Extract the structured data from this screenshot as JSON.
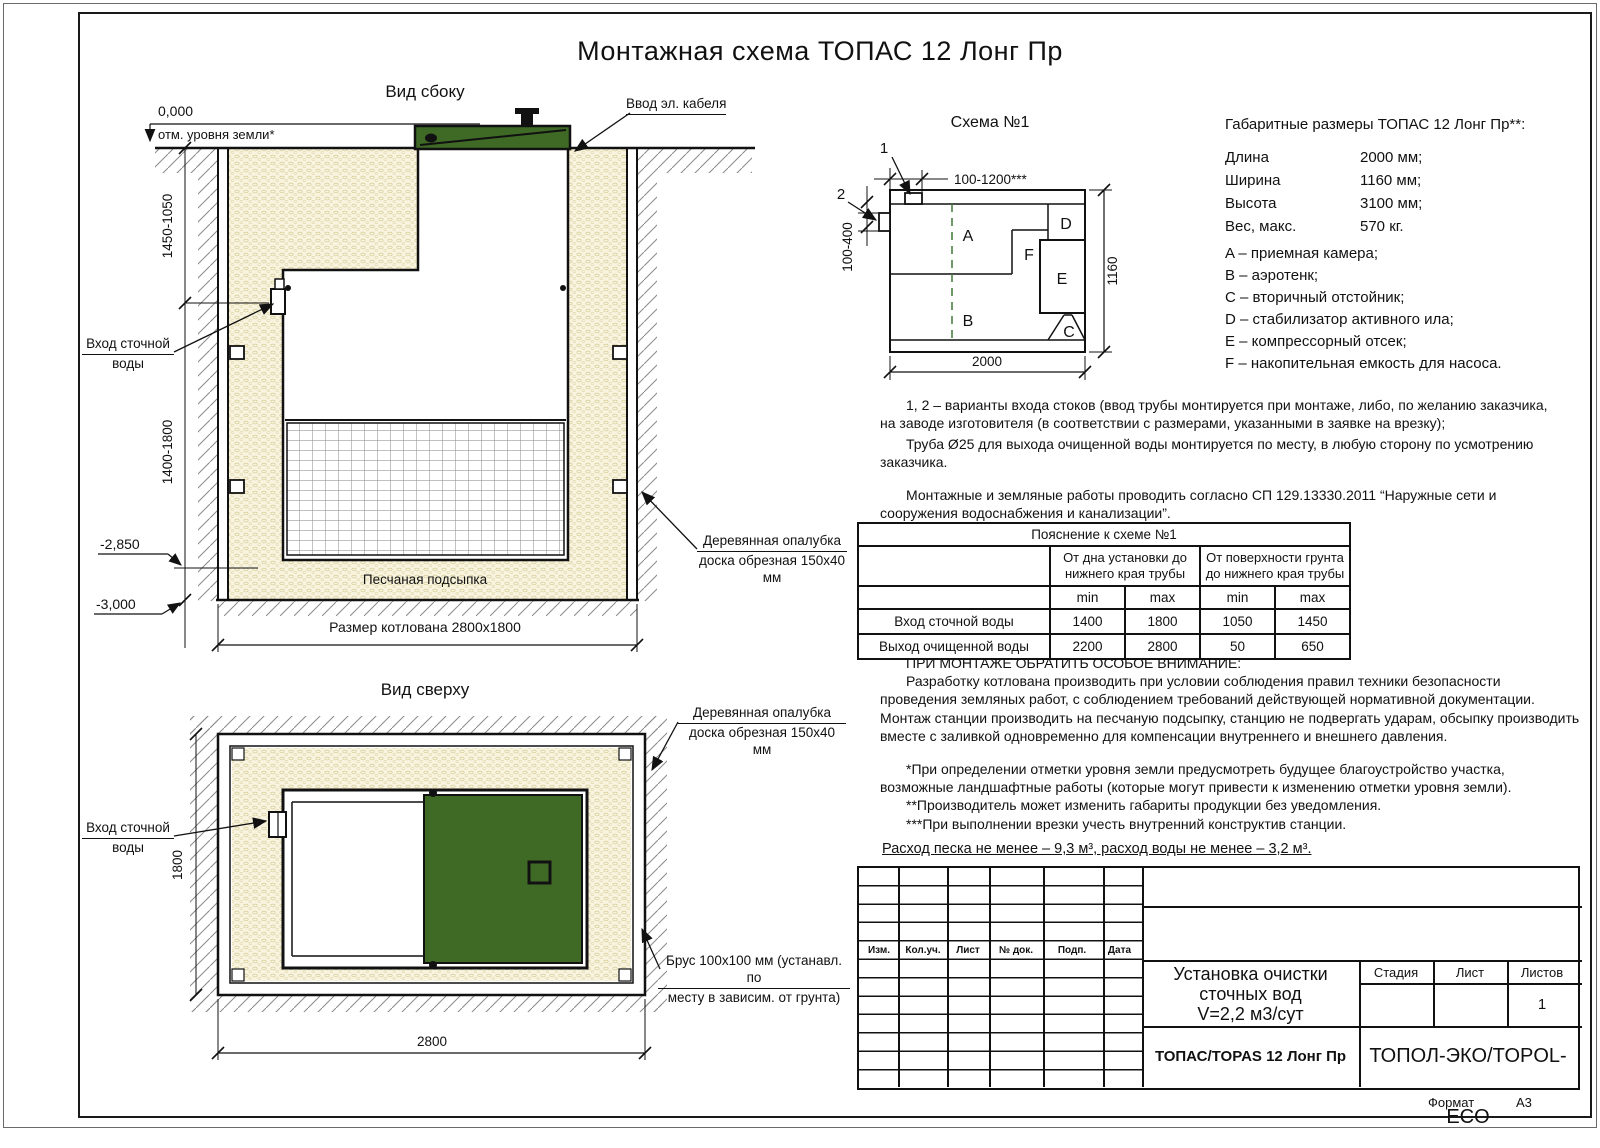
{
  "title": "Монтажная схема ТОПАС 12 Лонг Пр",
  "side_view": {
    "title": "Вид сбоку",
    "zero_mark": "0,000",
    "ground_label": "отм. уровня земли*",
    "cable_label": "Ввод эл. кабеля",
    "inlet_l1": "Вход сточной",
    "inlet_l2": "воды",
    "dim_upper": "1450-1050",
    "dim_lower": "1400-1800",
    "mark_sand": "-2,850",
    "mark_bottom": "-3,000",
    "sand_label": "Песчаная подсыпка",
    "pit_label": "Размер котлована 2800x1800",
    "formwork_l1": "Деревянная опалубка",
    "formwork_l2": "доска обрезная 150x40 мм"
  },
  "top_view": {
    "title": "Вид сверху",
    "formwork_l1": "Деревянная опалубка",
    "formwork_l2": "доска обрезная 150x40 мм",
    "inlet_l1": "Вход сточной",
    "inlet_l2": "воды",
    "beam_l1": "Брус 100x100 мм (устанавл. по",
    "beam_l2": "месту в зависим. от грунта)",
    "dim_width": "2800",
    "dim_depth": "1800"
  },
  "schema": {
    "title": "Схема №1",
    "ref1": "1",
    "ref2": "2",
    "dim_inlet_top": "100-1200***",
    "dim_inlet_side": "100-400",
    "dim_length": "2000",
    "dim_width": "1160",
    "comp_a": "A",
    "comp_b": "B",
    "comp_c": "C",
    "comp_d": "D",
    "comp_e": "E",
    "comp_f": "F"
  },
  "specs": {
    "title": "Габаритные размеры ТОПАС 12 Лонг Пр**:",
    "rows": [
      {
        "label": "Длина",
        "value": "2000 мм;"
      },
      {
        "label": "Ширина",
        "value": "1160 мм;"
      },
      {
        "label": "Высота",
        "value": "3100 мм;"
      },
      {
        "label": "Вес, макс.",
        "value": "570 кг."
      }
    ],
    "legend": [
      "A – приемная камера;",
      "B – аэротенк;",
      "C – вторичный отстойник;",
      "D – стабилизатор активного ила;",
      "E – компрессорный отсек;",
      "F – накопительная емкость для насоса."
    ]
  },
  "notes": {
    "n1": "1, 2 – варианты входа  стоков (ввод трубы монтируется при монтаже, либо, по желанию заказчика, на заводе изготовителя (в соответствии с размерами, указанными в заявке на врезку);",
    "n2": "Труба Ø25 для выхода очищенной воды монтируется по месту, в любую сторону по усмотрению заказчика.",
    "n3": "Монтажные и земляные работы проводить согласно СП 129.13330.2011 “Наружные сети и сооружения водоснабжения и канализации”."
  },
  "table": {
    "title": "Пояснение к схеме №1",
    "group1": "От дна установки до нижнего края трубы",
    "group2": "От поверхности грунта до нижнего края трубы",
    "min_label": "min",
    "max_label": "max",
    "rows": [
      {
        "label": "Вход сточной воды",
        "v": [
          "1400",
          "1800",
          "1050",
          "1450"
        ]
      },
      {
        "label": "Выход очищенной воды",
        "v": [
          "2200",
          "2800",
          "50",
          "650"
        ]
      }
    ]
  },
  "attention": {
    "heading": "ПРИ МОНТАЖЕ ОБРАТИТЬ ОСОБОЕ ВНИМАНИЕ:",
    "body": "Разработку котлована производить при условии соблюдения правил техники безопасности проведения земляных работ, с соблюдением требований действующей нормативной документации. Монтаж станции производить на песчаную подсыпку, станцию не подвергать ударам, обсыпку производить вместе с заливкой одновременно для компенсации внутреннего и внешнего давления.",
    "fn1": "*При определении отметки уровня земли предусмотреть будущее благоустройство участка, возможные ландшафтные работы (которые могут привести к изменению отметки уровня земли).",
    "fn2": "**Производитель может изменить габариты продукции без уведомления.",
    "fn3": "***При выполнении врезки учесть внутренний конструктив станции.",
    "consumption": "Расход песка не менее – 9,3 м³, расход воды не менее – 3,2 м³."
  },
  "stamp": {
    "cols": [
      "Изм.",
      "Кол.уч.",
      "Лист",
      "№ док.",
      "Подп.",
      "Дата"
    ],
    "project_l1": "Установка очистки",
    "project_l2": "сточных вод",
    "project_l3": "V=2,2 м3/сут",
    "stage": "Стадия",
    "sheet": "Лист",
    "sheets": "Листов",
    "sheets_value": "1",
    "model": "ТОПАС/TOPAS 12 Лонг Пр",
    "company": "ТОПОЛ-ЭКО/TOPOL-ECO",
    "format_label": "Формат",
    "format_value": "А3"
  },
  "colors": {
    "lid_green": "#3e6a26",
    "sand": "#f8f4e0",
    "dash_green": "#3c7a33"
  }
}
